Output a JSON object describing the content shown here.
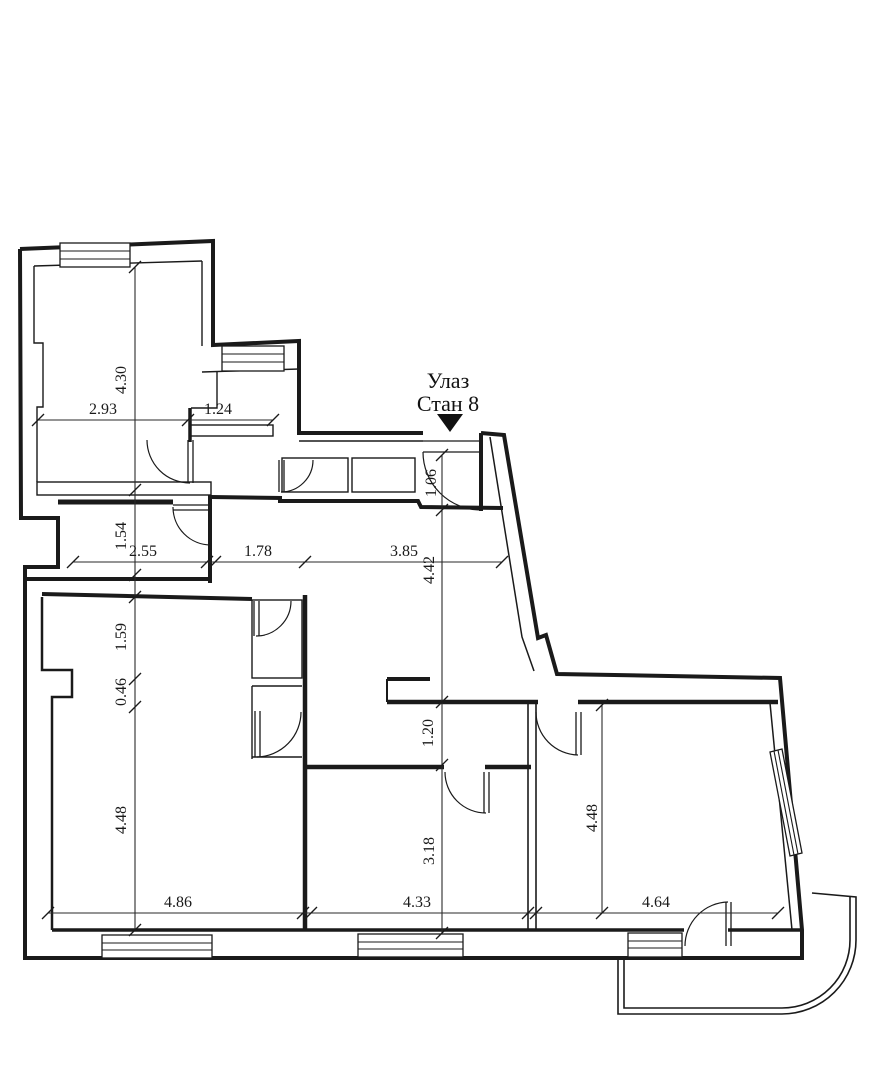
{
  "ink_color": "#1a1a1a",
  "entrance": {
    "line1": "Улаз",
    "line2": "Стан 8"
  },
  "dimensions": {
    "top_room_height": "4.30",
    "top_room_width": "2.93",
    "neck_width": "1.24",
    "wc_height": "1.54",
    "wc_width": "2.55",
    "hall_left_width": "1.78",
    "hall_right_width": "3.85",
    "hall_height": "4.42",
    "entry_width": "1.06",
    "living_upper_height": "1.59",
    "living_notch": "0.46",
    "living_height": "4.48",
    "corridor_height": "1.20",
    "middle_room_height": "3.18",
    "living_width": "4.86",
    "middle_room_width": "4.33",
    "right_room_width": "4.64",
    "right_room_height": "4.48"
  }
}
